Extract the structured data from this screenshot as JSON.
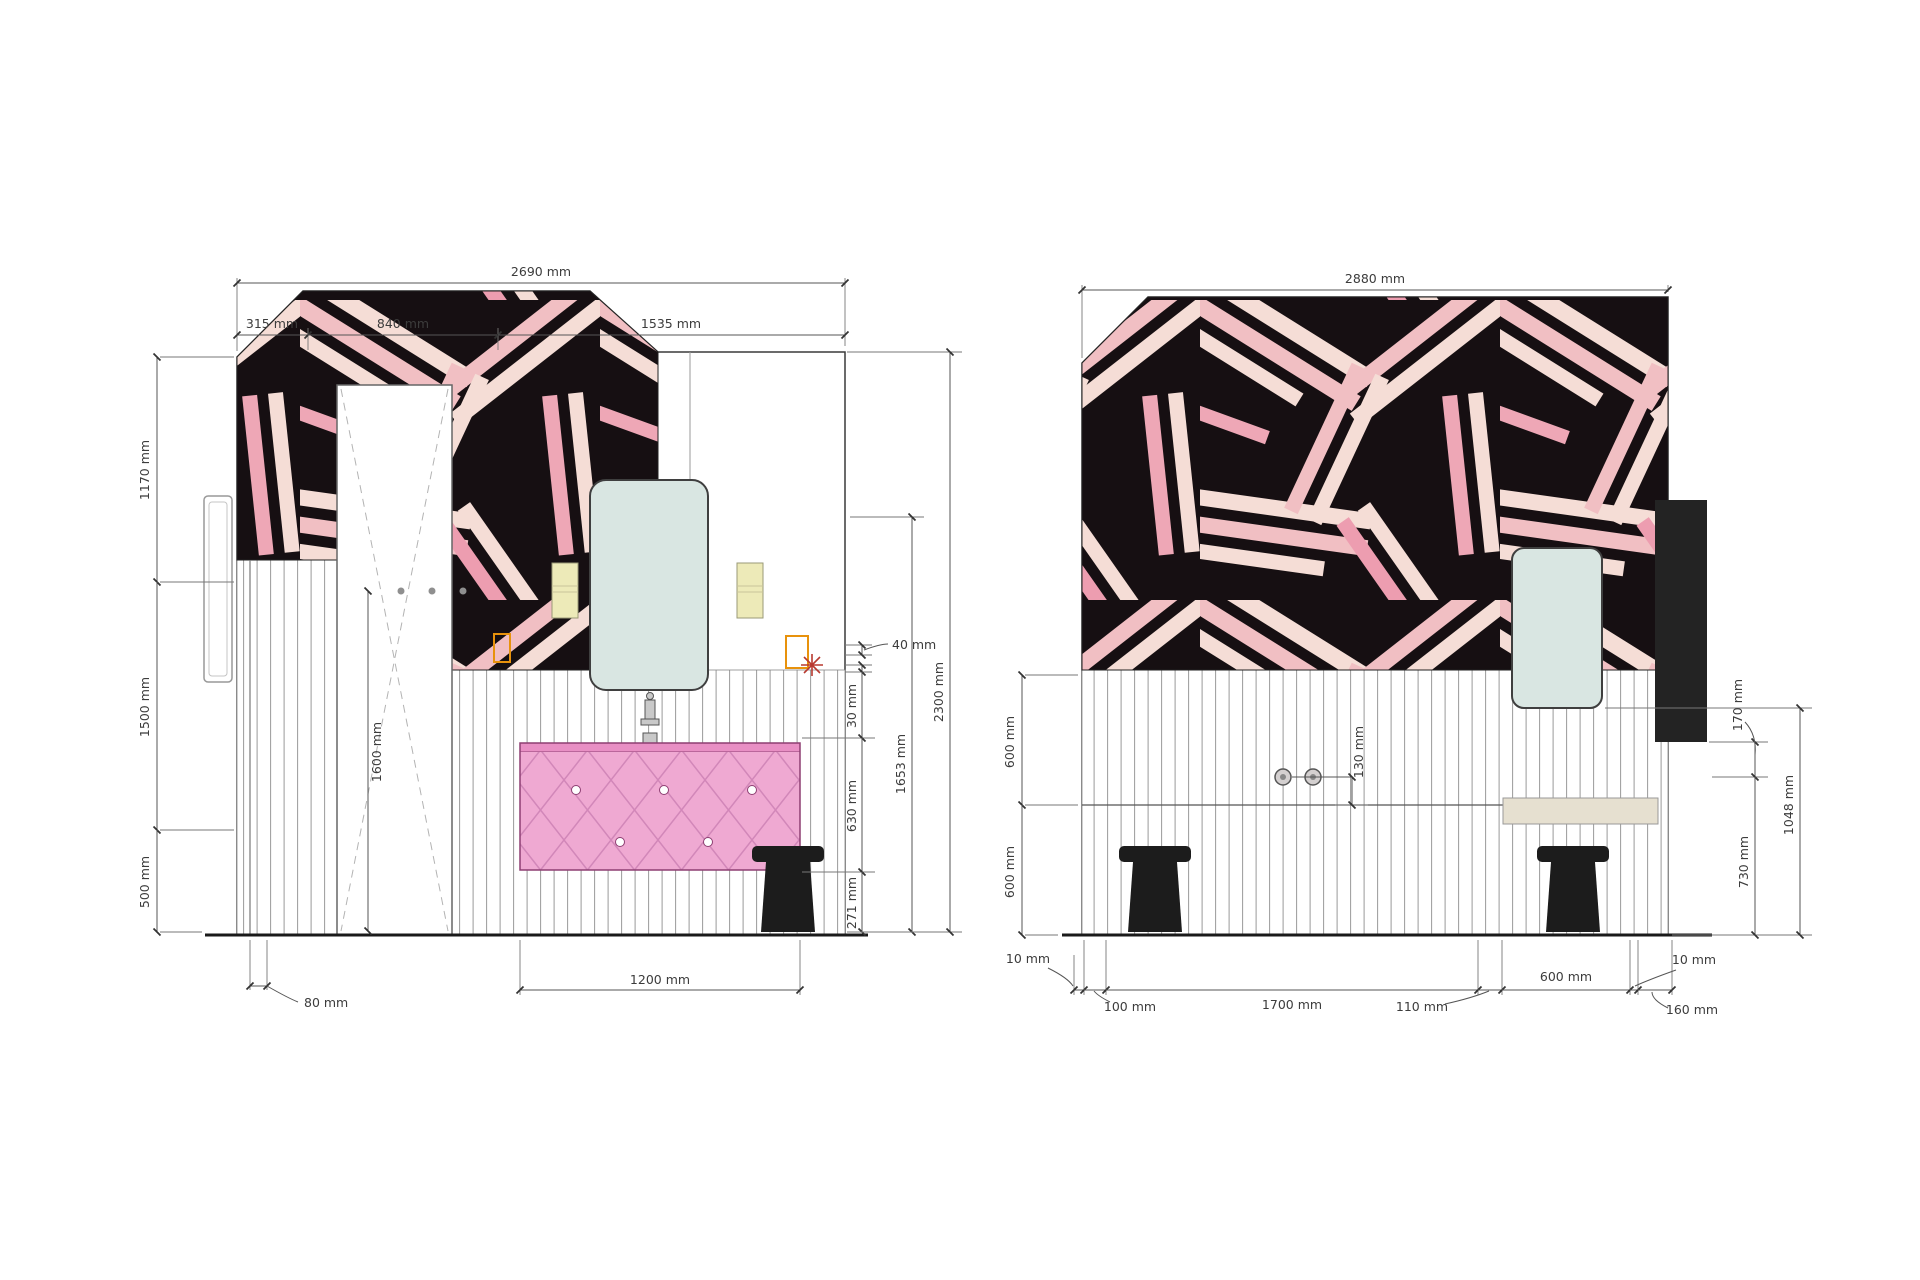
{
  "drawing": {
    "left_elevation": {
      "name": "bathroom-elevation-a",
      "dims": {
        "overall_width": "2690 mm",
        "top_segments": [
          "315 mm",
          "840 mm",
          "1535 mm"
        ],
        "left_heights": [
          "1170 mm",
          "1500 mm",
          "500 mm"
        ],
        "hook_height": "1600 mm",
        "frame_offset": "80 mm",
        "vanity_width": "1200 mm",
        "right_details": [
          "40 mm",
          "30 mm",
          "630 mm",
          "271 mm"
        ],
        "mirror_bottom_height": "1653 mm",
        "overall_height": "2300 mm"
      }
    },
    "right_elevation": {
      "name": "bathroom-elevation-b",
      "dims": {
        "overall_width": "2880 mm",
        "left_heights": [
          "600 mm",
          "600 mm"
        ],
        "tap_offset": "130 mm",
        "right_details": [
          "170 mm",
          "730 mm",
          "1048 mm"
        ],
        "bottom_segments": [
          "10 mm",
          "100 mm",
          "1700 mm",
          "110 mm",
          "600 mm",
          "10 mm",
          "160 mm"
        ]
      }
    },
    "colors": {
      "pattern_black": "#160f12",
      "pattern_cream": "#f5ddd6",
      "pattern_pink": "#f1bfc3",
      "pattern_rose": "#ed9db0",
      "vanity_pink": "#efa9d2",
      "vanity_line": "#d287b9",
      "mirror_glass": "#d9e6e2",
      "sconce_yellow": "#edeab8",
      "socket_orange": "#e8920c",
      "stool_black": "#1c1c1c",
      "counter_beige": "#e6e0d0",
      "dimension_line": "#555555"
    }
  }
}
